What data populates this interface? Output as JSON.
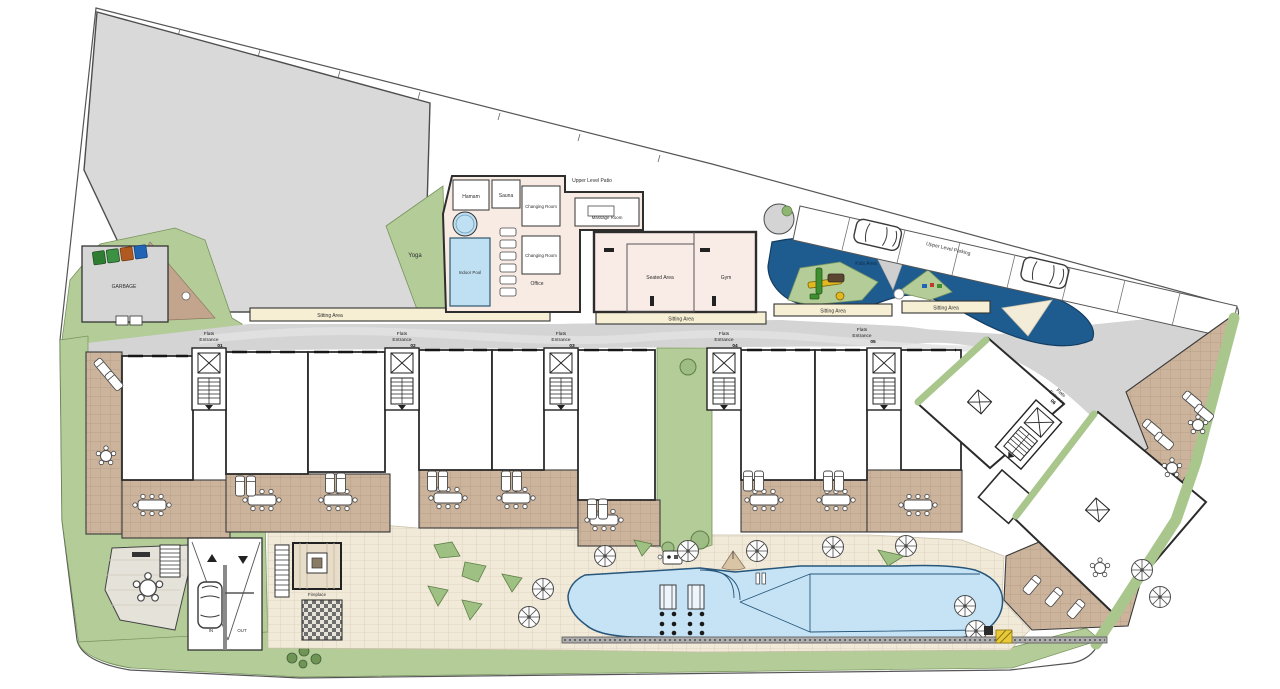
{
  "labels": {
    "upper_level_patio": "Upper Level Patio",
    "upper_level_parking": "Upper Level Parking",
    "massage_room": "Massage Room",
    "hamam": "Hamam",
    "sauna": "Sauna",
    "changing_room": "Changing Room",
    "office": "Office",
    "indoor_pool": "Indoor Pool",
    "yoga": "Yoga",
    "seated_area": "Seated Area",
    "gym": "Gym",
    "sitting_area": "Sitting Area",
    "kids_area": "Kids Area",
    "garbage": "GARBAGE",
    "fireplace": "Fireplace",
    "ramp_in": "IN",
    "ramp_out": "OUT"
  },
  "entrances": [
    {
      "line1": "Flats",
      "line2": "Entrance",
      "number": "01"
    },
    {
      "line1": "Flats",
      "line2": "Entrance",
      "number": "02"
    },
    {
      "line1": "Flats",
      "line2": "Entrance",
      "number": "03"
    },
    {
      "line1": "Flats",
      "line2": "Entrance",
      "number": "04"
    },
    {
      "line1": "Flats",
      "line2": "Entrance",
      "number": "05"
    },
    {
      "line1": "Flats",
      "line2": "Entrance",
      "number": "06"
    }
  ],
  "colors": {
    "green": "#b3cc98",
    "planter_green": "#9fc083",
    "roof_gray": "#d9d9d9",
    "road_gray": "#d4d4d4",
    "terrace_brown": "#cbb39c",
    "path_brown": "#c2a58c",
    "bench_beige": "#f6efd3",
    "water_dark": "#1e5c90",
    "water_light": "#c5e3f5",
    "building_cream": "#f7ebe4",
    "paving": "#f1ead9"
  }
}
